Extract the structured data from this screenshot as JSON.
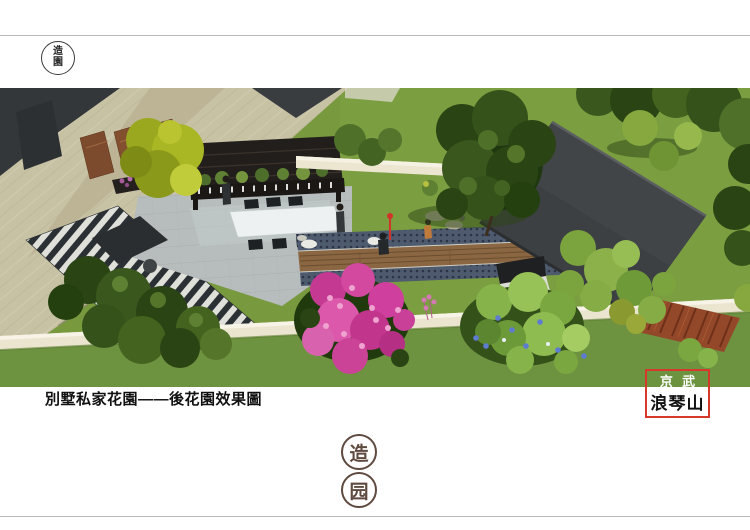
{
  "corner_seal": {
    "top_char": "造",
    "bottom_char": "園"
  },
  "caption": {
    "text": "別墅私家花園——後花園效果圖"
  },
  "brand_box": {
    "line1": "京 武",
    "line2": "浪琴山",
    "border_color": "#d5392b",
    "line1_color": "#ffffff",
    "line2_color": "#111111"
  },
  "footer_seal": {
    "top_char": "造",
    "bottom_char": "园",
    "color": "#5f4a40"
  },
  "render": {
    "description": "Aerial 3D rendering of a private villa back garden: beige stone house walls top-left, dark timber pergola with white dining table on grey stone patio, striped black-white deck, central wood-plank walkway with mosaic borders, pink flowering shrub, lawns, large dark flat roof at right, cream boundary wall, trees and bamboo",
    "palette": {
      "lawn": "#78993e",
      "building_stone": "#c8c2a5",
      "pergola": "#221e1b",
      "patio": "#b7bdbd",
      "wood_walkway": "#8a6742",
      "mosaic": "#4e5a6e",
      "flat_roof": "#3d4043",
      "boundary_wall": "#ebe5d0",
      "pink_flowers": "#cf3f9e",
      "copper_panels": "#7c4a2c",
      "red_screen": "#93482a"
    }
  }
}
